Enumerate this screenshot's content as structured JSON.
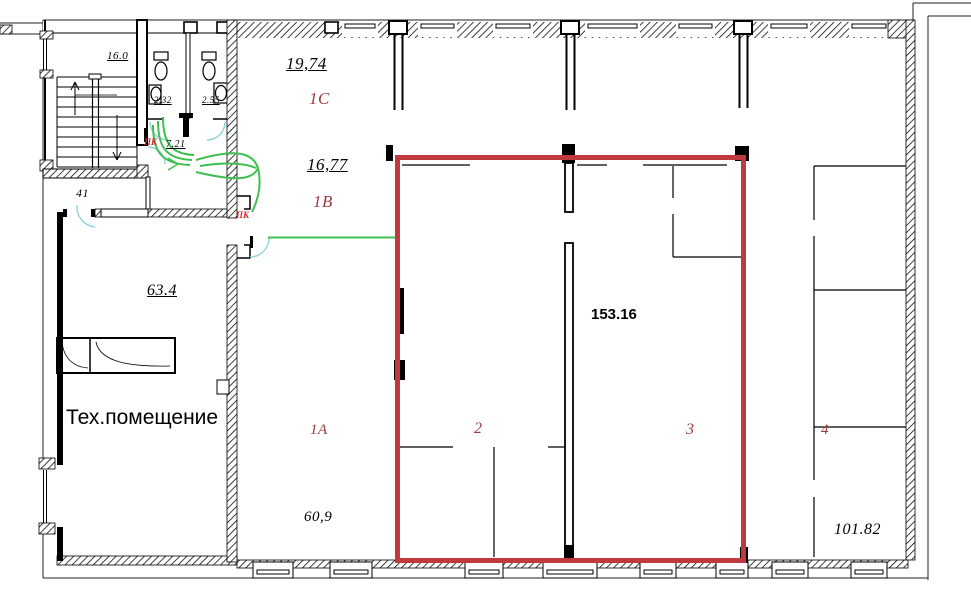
{
  "plan": {
    "type": "architectural-floor-plan",
    "highlight": {
      "area": "153.16",
      "color": "#c0393e"
    },
    "labels": {
      "area_1c": "19,74",
      "room_1c": "1C",
      "area_1b": "16,77",
      "room_1b": "1B",
      "room_1a": "1A",
      "area_1a": "60,9",
      "room_2": "2",
      "room_3": "3",
      "room_4": "4",
      "area_right": "101.82",
      "tech_room": "Тех.помещение",
      "area_tech": "63.4",
      "area_lobby": "41",
      "dim_stairs": "16.0",
      "area_wc_left": "2.32",
      "area_wc_right": "2.55",
      "area_corridor": "7.21",
      "pk_upper": "ПК",
      "pk_lower": "ПК"
    },
    "colors": {
      "highlight_outline": "#c0393e",
      "route_line": "#3fbf4f",
      "door_arc": "#8fd3d8",
      "room_label": "#9c3a3f",
      "pk_label": "#cf2e2e",
      "walls": "#000000"
    }
  }
}
